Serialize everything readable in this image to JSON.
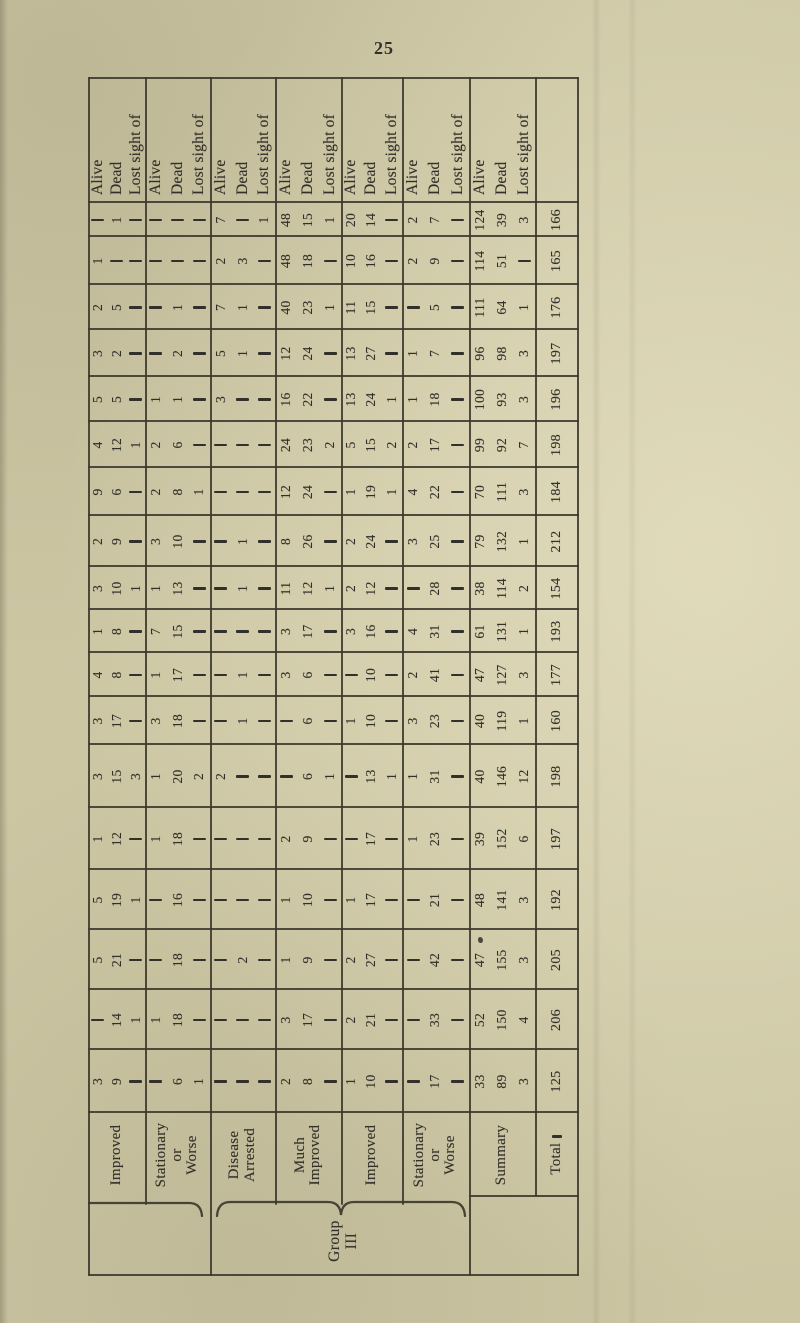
{
  "page": {
    "number": "25"
  },
  "colors": {
    "paper": "#ccc6a3",
    "ink": "#32302a",
    "rule": "#3a372c"
  },
  "table": {
    "sub_headers": [
      "Alive",
      "Dead",
      "Lost sight of"
    ],
    "num_data_columns": 18,
    "group_brace": {
      "label": "Group III",
      "label_lines": [
        "Group",
        "III"
      ]
    },
    "column_groups": [
      {
        "label": "Improved",
        "label_lines": [
          "Improved"
        ],
        "cells": [
          [
            "—",
            "1",
            "—"
          ],
          [
            "1",
            "—",
            "—"
          ],
          [
            "2",
            "5",
            "—"
          ],
          [
            "3",
            "2",
            "—"
          ],
          [
            "5",
            "5",
            "—"
          ],
          [
            "4",
            "12",
            "1"
          ],
          [
            "9",
            "6",
            "—"
          ],
          [
            "2",
            "9",
            "—"
          ],
          [
            "3",
            "10",
            "1"
          ],
          [
            "1",
            "8",
            "—"
          ],
          [
            "4",
            "8",
            "—"
          ],
          [
            "3",
            "17",
            "—"
          ],
          [
            "3",
            "15",
            "3"
          ],
          [
            "1",
            "12",
            "—"
          ],
          [
            "5",
            "19",
            "1"
          ],
          [
            "5",
            "21",
            "—"
          ],
          [
            "—",
            "14",
            "1"
          ],
          [
            "3",
            "9",
            "—"
          ]
        ]
      },
      {
        "label": "Stationary or Worse",
        "label_lines": [
          "Stationary",
          "or",
          "Worse"
        ],
        "cells": [
          [
            "—",
            "—",
            "—"
          ],
          [
            "—",
            "—",
            "—"
          ],
          [
            "—",
            "1",
            "—"
          ],
          [
            "—",
            "2",
            "—"
          ],
          [
            "1",
            "1",
            "—"
          ],
          [
            "2",
            "6",
            "—"
          ],
          [
            "2",
            "8",
            "1"
          ],
          [
            "3",
            "10",
            "—"
          ],
          [
            "1",
            "13",
            "—"
          ],
          [
            "7",
            "15",
            "—"
          ],
          [
            "1",
            "17",
            "—"
          ],
          [
            "3",
            "18",
            "—"
          ],
          [
            "1",
            "20",
            "2"
          ],
          [
            "1",
            "18",
            "—"
          ],
          [
            "—",
            "16",
            "—"
          ],
          [
            "—",
            "18",
            "—"
          ],
          [
            "1",
            "18",
            "—"
          ],
          [
            "—",
            "6",
            "1"
          ]
        ]
      },
      {
        "label": "Disease Arrested",
        "label_lines": [
          "Disease",
          "Arrested"
        ],
        "cells": [
          [
            "7",
            "—",
            "1"
          ],
          [
            "2",
            "3",
            "—"
          ],
          [
            "7",
            "1",
            "—"
          ],
          [
            "5",
            "1",
            "—"
          ],
          [
            "3",
            "—",
            "—"
          ],
          [
            "—",
            "—",
            "—"
          ],
          [
            "—",
            "—",
            "—"
          ],
          [
            "—",
            "1",
            "—"
          ],
          [
            "—",
            "1",
            "—"
          ],
          [
            "—",
            "—",
            "—"
          ],
          [
            "—",
            "1",
            "—"
          ],
          [
            "—",
            "1",
            "—"
          ],
          [
            "2",
            "—",
            "—"
          ],
          [
            "—",
            "—",
            "—"
          ],
          [
            "—",
            "—",
            "—"
          ],
          [
            "—",
            "2",
            "—"
          ],
          [
            "—",
            "—",
            "—"
          ],
          [
            "—",
            "—",
            "—"
          ]
        ]
      },
      {
        "label": "Much Improved",
        "label_lines": [
          "Much",
          "Improved"
        ],
        "cells": [
          [
            "48",
            "15",
            "1"
          ],
          [
            "48",
            "18",
            "—"
          ],
          [
            "40",
            "23",
            "1"
          ],
          [
            "12",
            "24",
            "—"
          ],
          [
            "16",
            "22",
            "—"
          ],
          [
            "24",
            "23",
            "2"
          ],
          [
            "12",
            "24",
            "—"
          ],
          [
            "8",
            "26",
            "—"
          ],
          [
            "11",
            "12",
            "1"
          ],
          [
            "3",
            "17",
            "—"
          ],
          [
            "3",
            "6",
            "—"
          ],
          [
            "—",
            "6",
            "—"
          ],
          [
            "—",
            "6",
            "1"
          ],
          [
            "2",
            "9",
            "—"
          ],
          [
            "1",
            "10",
            "—"
          ],
          [
            "1",
            "9",
            "—"
          ],
          [
            "3",
            "17",
            "—"
          ],
          [
            "2",
            "8",
            "—"
          ]
        ]
      },
      {
        "label": "Improved",
        "label_lines": [
          "Improved"
        ],
        "cells": [
          [
            "20",
            "14",
            "—"
          ],
          [
            "10",
            "16",
            "—"
          ],
          [
            "11",
            "15",
            "—"
          ],
          [
            "13",
            "27",
            "—"
          ],
          [
            "13",
            "24",
            "1"
          ],
          [
            "5",
            "15",
            "2"
          ],
          [
            "1",
            "19",
            "1"
          ],
          [
            "2",
            "24",
            "—"
          ],
          [
            "2",
            "12",
            "—"
          ],
          [
            "3",
            "16",
            "—"
          ],
          [
            "—",
            "10",
            "—"
          ],
          [
            "1",
            "10",
            "—"
          ],
          [
            "—",
            "13",
            "1"
          ],
          [
            "—",
            "17",
            "—"
          ],
          [
            "1",
            "17",
            "—"
          ],
          [
            "2",
            "27",
            "—"
          ],
          [
            "2",
            "21",
            "—"
          ],
          [
            "1",
            "10",
            "—"
          ]
        ]
      },
      {
        "label": "Stationary or Worse",
        "label_lines": [
          "Stationary",
          "or",
          "Worse"
        ],
        "cells": [
          [
            "2",
            "7",
            "—"
          ],
          [
            "2",
            "9",
            "—"
          ],
          [
            "—",
            "5",
            "—"
          ],
          [
            "1",
            "7",
            "—"
          ],
          [
            "1",
            "18",
            "—"
          ],
          [
            "2",
            "17",
            "—"
          ],
          [
            "4",
            "22",
            "—"
          ],
          [
            "3",
            "25",
            "—"
          ],
          [
            "—",
            "28",
            "—"
          ],
          [
            "4",
            "31",
            "—"
          ],
          [
            "2",
            "41",
            "—"
          ],
          [
            "3",
            "23",
            "—"
          ],
          [
            "1",
            "31",
            "—"
          ],
          [
            "1",
            "23",
            "—"
          ],
          [
            "—",
            "21",
            "—"
          ],
          [
            "—",
            "42",
            "—"
          ],
          [
            "—",
            "33",
            "—"
          ],
          [
            "—",
            "17",
            "—"
          ]
        ]
      },
      {
        "label": "Summary",
        "label_lines": [
          "Summary"
        ],
        "cells": [
          [
            "124",
            "39",
            "3"
          ],
          [
            "114",
            "51",
            "—"
          ],
          [
            "111",
            "64",
            "1"
          ],
          [
            "96",
            "98",
            "3"
          ],
          [
            "100",
            "93",
            "3"
          ],
          [
            "99",
            "92",
            "7"
          ],
          [
            "70",
            "111",
            "3"
          ],
          [
            "79",
            "132",
            "1"
          ],
          [
            "38",
            "114",
            "2"
          ],
          [
            "61",
            "131",
            "1"
          ],
          [
            "47",
            "127",
            "3"
          ],
          [
            "40",
            "119",
            "1"
          ],
          [
            "40",
            "146",
            "12"
          ],
          [
            "39",
            "152",
            "6"
          ],
          [
            "48",
            "141",
            "3"
          ],
          [
            "47",
            "155",
            "3"
          ],
          [
            "52",
            "150",
            "4"
          ],
          [
            "33",
            "89",
            "3"
          ]
        ]
      },
      {
        "label": "Total —",
        "label_lines": [
          "Total —"
        ],
        "single": true,
        "cells": [
          "166",
          "165",
          "176",
          "197",
          "196",
          "198",
          "184",
          "212",
          "154",
          "193",
          "177",
          "160",
          "198",
          "197",
          "192",
          "205",
          "206",
          "125"
        ]
      }
    ]
  }
}
